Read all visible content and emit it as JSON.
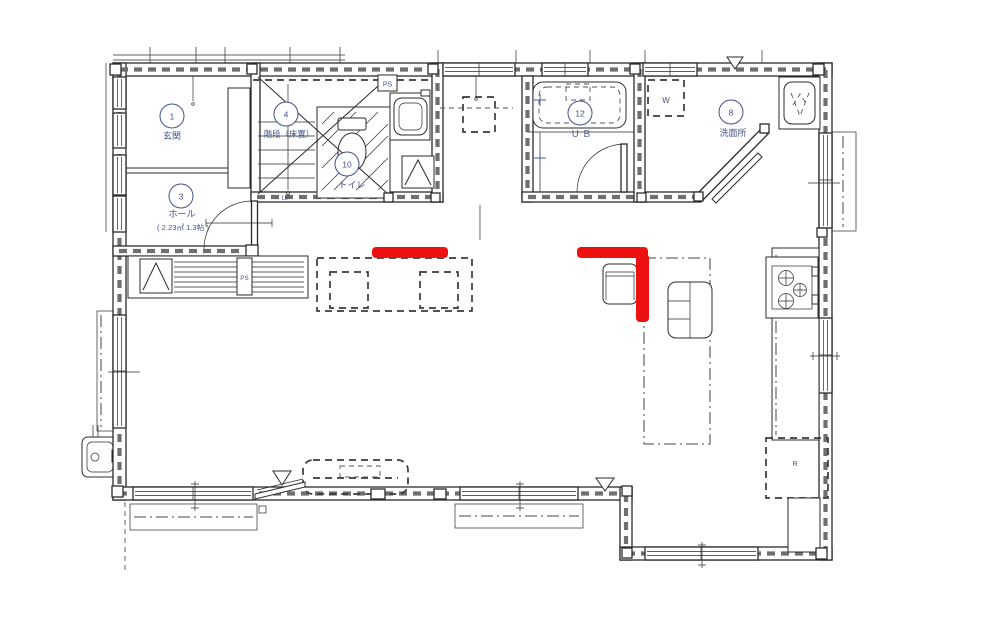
{
  "drawing": {
    "rooms": {
      "entrance": {
        "number": "1",
        "name": "玄関"
      },
      "hall": {
        "number": "3",
        "name": "ホール",
        "area": "( 2.23㎡ 1.3帖 )"
      },
      "stairs": {
        "number": "4",
        "name": "階段（床置）",
        "direction": "UP"
      },
      "toilet": {
        "number": "10",
        "name": "トイレ"
      },
      "unit_bath": {
        "number": "12",
        "name": "Ｕ Ｂ"
      },
      "washroom": {
        "number": "8",
        "name": "洗面所"
      }
    },
    "equipment": {
      "pipe_space_top": "PS",
      "pipe_space_hall": "PS",
      "washer": "W",
      "refrigerator": "R"
    },
    "colors": {
      "line": "#2b2b2b",
      "label": "#44508a",
      "highlight": "#ee1111"
    }
  }
}
